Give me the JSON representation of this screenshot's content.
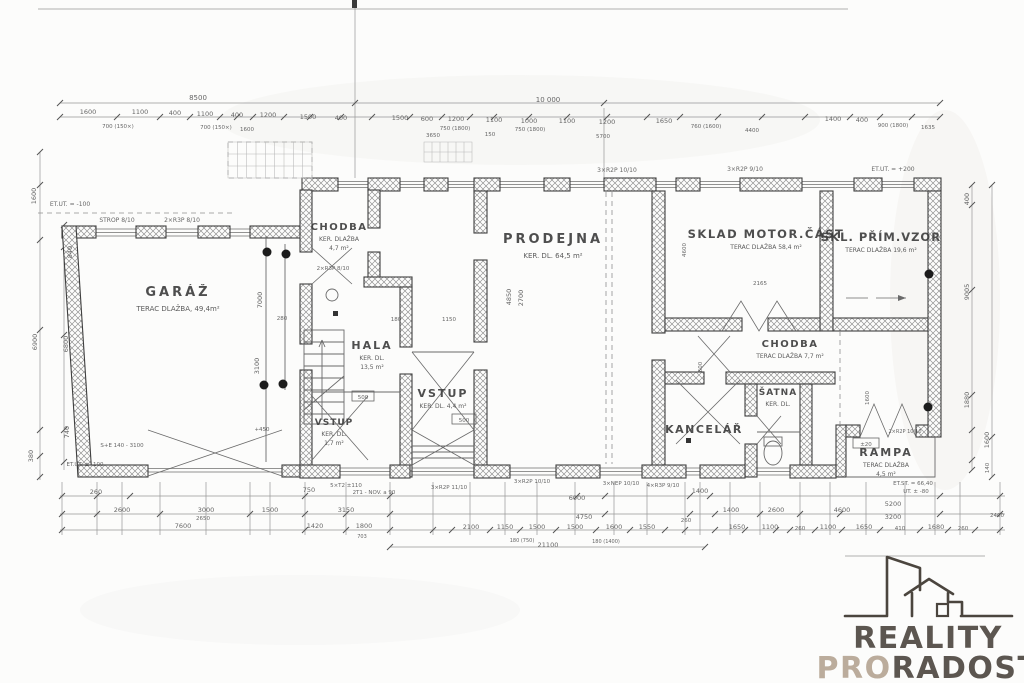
{
  "colors": {
    "paper": "#fcfcfb",
    "ink": "#3c3c3c",
    "dim_text": "#555555",
    "logo_dark": "#4b453e",
    "logo_beige": "#b5a492"
  },
  "logo": {
    "reality": "REALITY",
    "pro": "PRO",
    "radost": "RADOST"
  },
  "rooms": [
    {
      "name": "GARÁŽ",
      "lines": [
        "TERAC DLAŽBA, 49,4m²"
      ],
      "x": 178,
      "y": 296,
      "fs": 13,
      "ls": 3
    },
    {
      "name": "CHODBA",
      "lines": [
        "KER. DLAŽBA",
        "4,7 m²"
      ],
      "x": 339,
      "y": 230,
      "fs": 10,
      "ls": 1.5
    },
    {
      "name": "HALA",
      "lines": [
        "KER. DL.",
        "13,5 m²"
      ],
      "x": 372,
      "y": 349,
      "fs": 11,
      "ls": 2
    },
    {
      "name": "VSTUP",
      "lines": [
        "KER. DL.",
        "1,7 m²"
      ],
      "x": 334,
      "y": 425,
      "fs": 9,
      "ls": 1
    },
    {
      "name": "VSTUP",
      "lines": [
        "KER. DL.  4,4 m²"
      ],
      "x": 443,
      "y": 397,
      "fs": 11,
      "ls": 2
    },
    {
      "name": "PRODEJNA",
      "lines": [
        "KER. DL.  64,5 m²"
      ],
      "x": 553,
      "y": 243,
      "fs": 13,
      "ls": 3
    },
    {
      "name": "SKLAD MOTOR.ČÁST",
      "lines": [
        "TERAC DLAŽBA  58,4 m²"
      ],
      "x": 766,
      "y": 238,
      "fs": 11.5,
      "ls": 1.5
    },
    {
      "name": "SKL. PŘÍM.VZOR",
      "lines": [
        "TERAC DLAŽBA  19,6 m²"
      ],
      "x": 881,
      "y": 241,
      "fs": 11.5,
      "ls": 1
    },
    {
      "name": "CHODBA",
      "lines": [
        "TERAC DLAŽBA  7,7 m²"
      ],
      "x": 790,
      "y": 347,
      "fs": 10,
      "ls": 1.5
    },
    {
      "name": "KANCELÁŘ",
      "lines": [],
      "x": 704,
      "y": 433,
      "fs": 11,
      "ls": 1.5
    },
    {
      "name": "ŠATNA",
      "lines": [
        "KER. DL."
      ],
      "x": 778,
      "y": 395,
      "fs": 9,
      "ls": 1
    },
    {
      "name": "RAMPA",
      "lines": [
        "TERAC DLAŽBA",
        "4,5 m²"
      ],
      "x": 886,
      "y": 456,
      "fs": 11,
      "ls": 2
    }
  ],
  "annotations": [
    {
      "t": "8500",
      "x": 198,
      "y": 100,
      "s": 7
    },
    {
      "t": "10 000",
      "x": 548,
      "y": 102,
      "s": 7
    },
    {
      "t": "1600",
      "x": 88,
      "y": 114
    },
    {
      "t": "1100",
      "x": 140,
      "y": 114
    },
    {
      "t": "400",
      "x": 175,
      "y": 115
    },
    {
      "t": "1100",
      "x": 205,
      "y": 116
    },
    {
      "t": "400",
      "x": 237,
      "y": 117
    },
    {
      "t": "1200",
      "x": 268,
      "y": 117
    },
    {
      "t": "1500",
      "x": 308,
      "y": 119
    },
    {
      "t": "400",
      "x": 341,
      "y": 120
    },
    {
      "t": "1500",
      "x": 400,
      "y": 120
    },
    {
      "t": "600",
      "x": 427,
      "y": 121
    },
    {
      "t": "1200",
      "x": 456,
      "y": 121
    },
    {
      "t": "1100",
      "x": 494,
      "y": 122
    },
    {
      "t": "1000",
      "x": 529,
      "y": 123
    },
    {
      "t": "1100",
      "x": 567,
      "y": 123
    },
    {
      "t": "1200",
      "x": 607,
      "y": 124
    },
    {
      "t": "1650",
      "x": 664,
      "y": 123
    },
    {
      "t": "1400",
      "x": 833,
      "y": 121
    },
    {
      "t": "400",
      "x": 862,
      "y": 122
    },
    {
      "t": "700 (150×)",
      "x": 118,
      "y": 128,
      "s": 5.5
    },
    {
      "t": "700 (150×)",
      "x": 216,
      "y": 129,
      "s": 5.5
    },
    {
      "t": "1600",
      "x": 247,
      "y": 131,
      "s": 5.5
    },
    {
      "t": "750 (1800)",
      "x": 455,
      "y": 130,
      "s": 5.5
    },
    {
      "t": "750 (1800)",
      "x": 530,
      "y": 131,
      "s": 5.5
    },
    {
      "t": "760 (1600)",
      "x": 706,
      "y": 128,
      "s": 5.5
    },
    {
      "t": "900 (1800)",
      "x": 893,
      "y": 127,
      "s": 5.5
    },
    {
      "t": "1635",
      "x": 928,
      "y": 129,
      "s": 5.5
    },
    {
      "t": "3650",
      "x": 433,
      "y": 137,
      "s": 5.5
    },
    {
      "t": "150",
      "x": 490,
      "y": 136,
      "s": 5.5
    },
    {
      "t": "5700",
      "x": 603,
      "y": 138,
      "s": 5.5
    },
    {
      "t": "4400",
      "x": 752,
      "y": 132,
      "s": 5.5
    },
    {
      "t": "ET.UT. = -100",
      "x": 70,
      "y": 206,
      "s": 6
    },
    {
      "t": "STROP 8/10",
      "x": 117,
      "y": 222,
      "s": 6
    },
    {
      "t": "2×R3P 8/10",
      "x": 182,
      "y": 222,
      "s": 6
    },
    {
      "t": "3×R2P 10/10",
      "x": 617,
      "y": 172,
      "s": 6
    },
    {
      "t": "3×R2P 9/10",
      "x": 745,
      "y": 171,
      "s": 6
    },
    {
      "t": "ET.UT. = +200",
      "x": 893,
      "y": 171,
      "s": 6
    },
    {
      "t": "2×R3P 8/10",
      "x": 333,
      "y": 270,
      "s": 5.5
    },
    {
      "t": "1600",
      "x": 36,
      "y": 196,
      "r": -90
    },
    {
      "t": "840",
      "x": 72,
      "y": 252,
      "r": -90
    },
    {
      "t": "6900",
      "x": 37,
      "y": 342,
      "r": -90
    },
    {
      "t": "6800",
      "x": 68,
      "y": 344,
      "r": -90
    },
    {
      "t": "740",
      "x": 69,
      "y": 432,
      "r": -90
    },
    {
      "t": "380",
      "x": 33,
      "y": 456,
      "r": -90
    },
    {
      "t": "400",
      "x": 969,
      "y": 199,
      "r": -90
    },
    {
      "t": "9005",
      "x": 969,
      "y": 292,
      "r": -90
    },
    {
      "t": "1880",
      "x": 969,
      "y": 400,
      "r": -90
    },
    {
      "t": "1600",
      "x": 989,
      "y": 440,
      "r": -90
    },
    {
      "t": "140",
      "x": 989,
      "y": 468,
      "r": -90,
      "s": 5.5
    },
    {
      "t": "7000",
      "x": 262,
      "y": 300,
      "r": -90
    },
    {
      "t": "3100",
      "x": 259,
      "y": 366,
      "r": -90
    },
    {
      "t": "280",
      "x": 282,
      "y": 320,
      "s": 5.5
    },
    {
      "t": "4850",
      "x": 511,
      "y": 297,
      "r": -90
    },
    {
      "t": "2700",
      "x": 523,
      "y": 298,
      "r": -90
    },
    {
      "t": "180",
      "x": 396,
      "y": 321,
      "s": 5.5
    },
    {
      "t": "1150",
      "x": 449,
      "y": 321,
      "s": 5.5
    },
    {
      "t": "2165",
      "x": 760,
      "y": 285,
      "s": 5.5
    },
    {
      "t": "4600",
      "x": 686,
      "y": 250,
      "r": -90,
      "s": 5.5
    },
    {
      "t": "600",
      "x": 702,
      "y": 367,
      "r": -90,
      "s": 5.5
    },
    {
      "t": "1600",
      "x": 869,
      "y": 398,
      "r": -90,
      "s": 5.5
    },
    {
      "t": "+450",
      "x": 262,
      "y": 431,
      "s": 5.5
    },
    {
      "t": "500",
      "x": 363,
      "y": 399,
      "s": 5.5
    },
    {
      "t": "500",
      "x": 464,
      "y": 422,
      "s": 5.5
    },
    {
      "t": "±20",
      "x": 866,
      "y": 446,
      "s": 5.5
    },
    {
      "t": "2×R2P 10/10",
      "x": 905,
      "y": 433,
      "s": 5
    },
    {
      "t": "S+E 140 - 3100",
      "x": 122,
      "y": 447,
      "s": 5.5
    },
    {
      "t": "ET.UT. ± -100",
      "x": 85,
      "y": 466,
      "s": 5.5
    },
    {
      "t": "5×T2 ±110",
      "x": 346,
      "y": 487,
      "s": 5.5
    },
    {
      "t": "2T1 - NOV. a 90",
      "x": 374,
      "y": 494,
      "s": 5.5
    },
    {
      "t": "3×R2P 11/10",
      "x": 449,
      "y": 489,
      "s": 5.5
    },
    {
      "t": "3×R2P 10/10",
      "x": 532,
      "y": 483,
      "s": 5.5
    },
    {
      "t": "3×NEP 10/10",
      "x": 621,
      "y": 485,
      "s": 5.5
    },
    {
      "t": "4×R3P 9/10",
      "x": 663,
      "y": 487,
      "s": 5.5
    },
    {
      "t": "ET.ST. = 66,40",
      "x": 913,
      "y": 485,
      "s": 5.5
    },
    {
      "t": "UT. ± -80",
      "x": 916,
      "y": 493,
      "s": 5.5
    },
    {
      "t": "260",
      "x": 96,
      "y": 494
    },
    {
      "t": "750",
      "x": 309,
      "y": 492
    },
    {
      "t": "1400",
      "x": 700,
      "y": 493
    },
    {
      "t": "6000",
      "x": 577,
      "y": 500
    },
    {
      "t": "5200",
      "x": 893,
      "y": 506
    },
    {
      "t": "2600",
      "x": 122,
      "y": 512
    },
    {
      "t": "3000",
      "x": 206,
      "y": 512
    },
    {
      "t": "2650",
      "x": 203,
      "y": 520,
      "s": 5.5
    },
    {
      "t": "1500",
      "x": 270,
      "y": 512
    },
    {
      "t": "3150",
      "x": 346,
      "y": 512
    },
    {
      "t": "4750",
      "x": 584,
      "y": 519
    },
    {
      "t": "260",
      "x": 686,
      "y": 522,
      "s": 5.5
    },
    {
      "t": "1400",
      "x": 731,
      "y": 512
    },
    {
      "t": "2600",
      "x": 776,
      "y": 512
    },
    {
      "t": "4600",
      "x": 842,
      "y": 512
    },
    {
      "t": "3200",
      "x": 893,
      "y": 519
    },
    {
      "t": "7600",
      "x": 183,
      "y": 528
    },
    {
      "t": "1420",
      "x": 315,
      "y": 528
    },
    {
      "t": "1800",
      "x": 364,
      "y": 528
    },
    {
      "t": "703",
      "x": 362,
      "y": 538,
      "s": 5
    },
    {
      "t": "2100",
      "x": 471,
      "y": 529
    },
    {
      "t": "1150",
      "x": 505,
      "y": 529
    },
    {
      "t": "1500",
      "x": 537,
      "y": 529
    },
    {
      "t": "1500",
      "x": 575,
      "y": 529
    },
    {
      "t": "1600",
      "x": 614,
      "y": 529
    },
    {
      "t": "1550",
      "x": 647,
      "y": 529
    },
    {
      "t": "1650",
      "x": 737,
      "y": 529
    },
    {
      "t": "1100",
      "x": 770,
      "y": 529
    },
    {
      "t": "260",
      "x": 800,
      "y": 530,
      "s": 5.5
    },
    {
      "t": "1100",
      "x": 828,
      "y": 529
    },
    {
      "t": "1650",
      "x": 864,
      "y": 529
    },
    {
      "t": "410",
      "x": 900,
      "y": 530,
      "s": 5.5
    },
    {
      "t": "1680",
      "x": 936,
      "y": 529
    },
    {
      "t": "260",
      "x": 963,
      "y": 530,
      "s": 5.5
    },
    {
      "t": "2400",
      "x": 997,
      "y": 517,
      "s": 5.5
    },
    {
      "t": "180 (750)",
      "x": 522,
      "y": 542,
      "s": 5
    },
    {
      "t": "180 (1400)",
      "x": 606,
      "y": 543,
      "s": 5
    },
    {
      "t": "21100",
      "x": 548,
      "y": 547
    }
  ]
}
